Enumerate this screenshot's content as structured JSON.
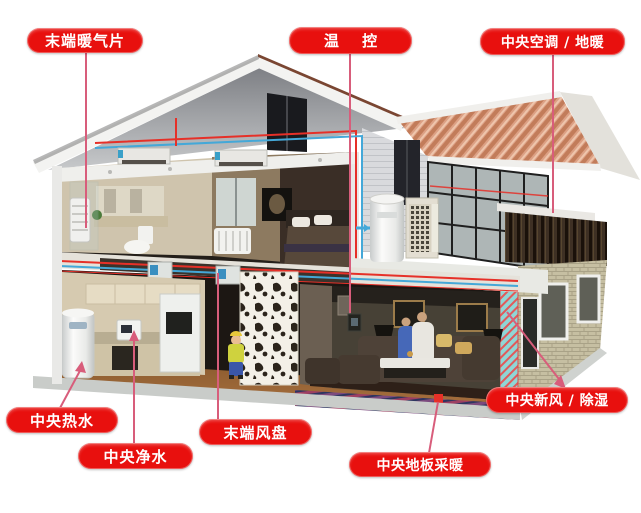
{
  "labels": {
    "terminal_radiator": {
      "text": "末端暖气片"
    },
    "thermostat": {
      "text": "温 控"
    },
    "central_ac_floor_heating": {
      "text": "中央空调 / 地暖"
    },
    "central_hot_water": {
      "text": "中央热水"
    },
    "central_water_purifier": {
      "text": "中央净水"
    },
    "terminal_fan_coil": {
      "text": "末端风盘"
    },
    "central_floor_heating": {
      "text": "中央地板采暖"
    },
    "fresh_air_dehumidifier": {
      "text": "中央新风 / 除湿"
    }
  },
  "colors": {
    "label_bg": "#e8100e",
    "label_text": "#ffffff",
    "leader_line": "#d85d7b",
    "pipe_hot": "#e63028",
    "pipe_cold": "#44a8d8",
    "roof_tile": "#cf8a68"
  }
}
